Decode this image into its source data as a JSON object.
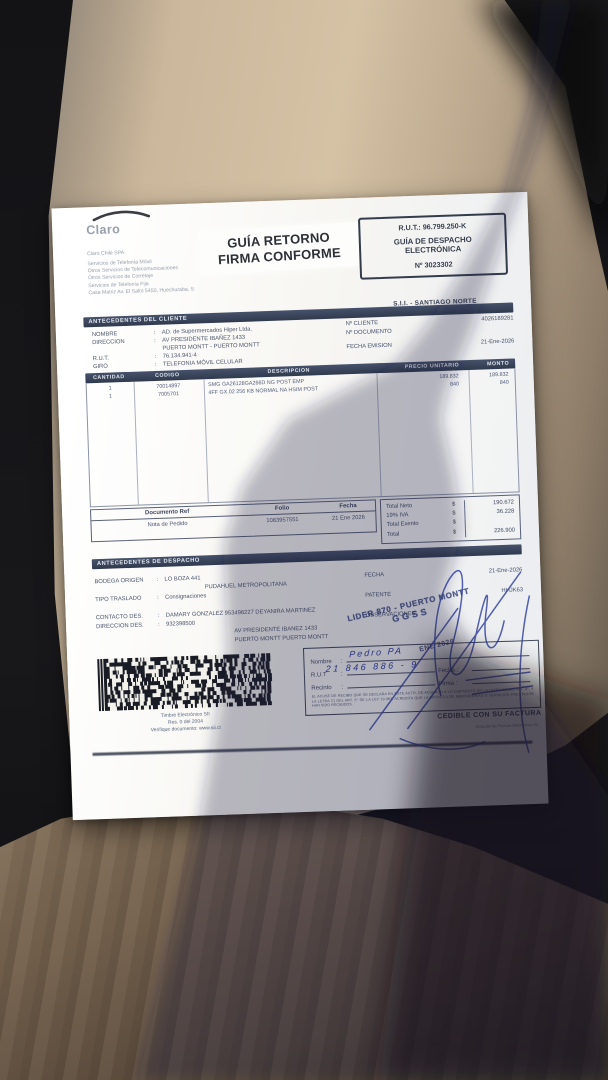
{
  "header": {
    "brand": "Claro",
    "company_lines": {
      "l0": "Claro Chile SPA",
      "l1": "Servicios de Telefonía Móvil",
      "l2": "Otros Servicios de Telecomunicaciones",
      "l3": "Otros Servicios de Corretaje",
      "l4": "Servicios de Telefonía Fija",
      "l5": "Casa Matriz Av. El Salto 5450, Huechuraba, S"
    },
    "return_stamp": {
      "line1": "GUÍA RETORNO",
      "line2": "FIRMA CONFORME"
    },
    "rut_box": {
      "rut": "R.U.T.: 96.799.250-K",
      "doc_type": "GUÍA DE DESPACHO ELECTRÓNICA",
      "number": "Nº 3023302"
    },
    "sii_office": "S.I.I. - SANTIAGO NORTE"
  },
  "client": {
    "title": "ANTECEDENTES DEL CLIENTE",
    "labels": {
      "nombre": "NOMBRE",
      "direccion": "DIRECCION",
      "rut": "R.U.T.",
      "giro": "GIRO",
      "n_cliente": "Nº CLIENTE",
      "n_documento": "Nº DOCUMENTO",
      "fecha_emision": "FECHA EMISION"
    },
    "values": {
      "nombre": "AD. de Supermercados Hiper Ltda.",
      "direccion1": "AV PRESIDENTE IBAÑEZ 1433",
      "direccion2": "PUERTO MONTT - PUERTO MONTT",
      "rut": "76.134.941-4",
      "giro": "TELEFONIA MÓVIL CELULAR",
      "n_cliente": "4026189281",
      "n_documento": "",
      "fecha_emision": "21-Ene-2026"
    }
  },
  "items": {
    "headers": {
      "cantidad": "CANTIDAD",
      "codigo": "CODIGO",
      "descripcion": "DESCRIPCION",
      "precio": "PRECIO UNITARIO",
      "monto": "MONTO"
    },
    "rows": [
      {
        "cantidad": "1",
        "codigo": "70014897",
        "descripcion": "SMG GA26128GA266D NG POST EMP",
        "precio": "189.832",
        "monto": "189.832"
      },
      {
        "cantidad": "1",
        "codigo": "7005701",
        "descripcion": "4FF GX.02 256 KB NORMAL NA HSIM POST",
        "precio": "840",
        "monto": "840"
      }
    ]
  },
  "reference": {
    "headers": {
      "doc": "Documento Ref",
      "folio": "Folio",
      "fecha": "Fecha"
    },
    "values": {
      "doc": "Nota de Pedido",
      "folio": "1083957551",
      "fecha": "21 Ene 2026"
    }
  },
  "totals": {
    "currency": "$",
    "neto_label": "Total Neto",
    "neto": "190.672",
    "iva_label": "19% IVA",
    "iva": "36.228",
    "exento_label": "Total Exento",
    "exento": "",
    "total_label": "Total",
    "total": "226.900"
  },
  "dispatch": {
    "title": "ANTECEDENTES DE DESPACHO",
    "labels": {
      "bodega": "BODEGA ORIGEN",
      "tipo": "TIPO TRASLADO",
      "fecha": "FECHA",
      "patente": "PATENTE",
      "contacto": "CONTACTO DES.",
      "observaciones": "OBSERVACIONES",
      "direccion": "DIRECCION DES."
    },
    "values": {
      "bodega1": "LO BOZA 441",
      "bodega2": "PUDAHUEL METROPOLITANA",
      "tipo": "Consignaciones",
      "fecha": "21-Ene-2026",
      "patente": "HHJK63",
      "contacto": "DAMARY GONZALEZ 953498227 DEYANIRA MARTINEZ",
      "direccion1": "932398500",
      "direccion2": "AV PRESIDENTE IBANEZ 1433",
      "direccion3": "PUERTO MONTT PUERTO MONTT"
    }
  },
  "reception": {
    "labels": {
      "nombre": "Nombre",
      "rut": "R.U.T",
      "recinto": "Recinto",
      "fecha": "Fecha :",
      "firma": "Firma :"
    },
    "handwritten": {
      "nombre": "Pedro PA",
      "rut": "21 846 886 - 9"
    },
    "legal": "EL ACUSE DE RECIBO QUE SE DECLARA EN ESTE ACTO, DE ACUERDO A LO DISPUESTO EN LA LETRA B) DEL ART. 4°, Y LA LETRA C) DEL ART. 5° DE LA LEY 19.983, ACREDITA QUE LA ENTREGA DE MERCADERIAS O SERVICIOS PRESTADOS HAN SIDO RECIBIDOS.",
    "cedible": "CEDIBLE CON SU FACTURA"
  },
  "stamps": {
    "lider_line1": "LIDER 870 - PUERTO MONTT",
    "lider_line2": "GGSS",
    "date_stamp": "ENE 2026"
  },
  "barcode": {
    "caption1": "Timbre Electrónico SII",
    "caption2": "Res. 0 del 2004",
    "caption3": "Verifique documento: www.sii.cl"
  },
  "footer": {
    "provider": "Solución de Factura Electrónica de"
  },
  "colors": {
    "section_bar": "#3a4459",
    "ink": "#454e63",
    "pen_blue": "#2b3aa0",
    "stamp_blue": "#2c3a72",
    "seat": "#cbb79b",
    "fabric": "#74614d"
  }
}
